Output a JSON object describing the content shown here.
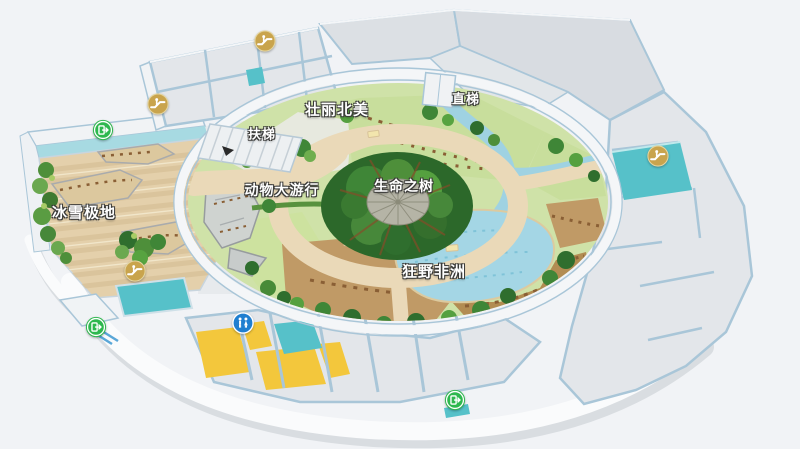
{
  "map": {
    "kind": "indoor-zoo-floor-map",
    "labels": [
      {
        "id": "bingxue-jidi",
        "text": "冰雪极地",
        "x": 84,
        "y": 212,
        "size": 15
      },
      {
        "id": "zhuangli-beimei",
        "text": "壮丽北美",
        "x": 337,
        "y": 109,
        "size": 15
      },
      {
        "id": "kuangye-feizhou",
        "text": "狂野非洲",
        "x": 434,
        "y": 271,
        "size": 15
      },
      {
        "id": "shengming-zhishu",
        "text": "生命之树",
        "x": 404,
        "y": 186,
        "size": 14
      },
      {
        "id": "dongwu-dayouxing",
        "text": "动物大游行",
        "x": 282,
        "y": 190,
        "size": 14
      },
      {
        "id": "futi",
        "text": "扶梯",
        "x": 262,
        "y": 133,
        "size": 13
      },
      {
        "id": "zhiti",
        "text": "直梯",
        "x": 466,
        "y": 98,
        "size": 13
      }
    ],
    "markers": [
      {
        "type": "escalator",
        "x": 265,
        "y": 41
      },
      {
        "type": "escalator",
        "x": 158,
        "y": 104
      },
      {
        "type": "escalator",
        "x": 135,
        "y": 271
      },
      {
        "type": "escalator",
        "x": 658,
        "y": 156
      },
      {
        "type": "exit",
        "x": 103,
        "y": 130
      },
      {
        "type": "exit",
        "x": 96,
        "y": 327
      },
      {
        "type": "exit",
        "x": 455,
        "y": 400
      },
      {
        "type": "restroom",
        "x": 243,
        "y": 323
      }
    ]
  },
  "colors": {
    "bg": "#f1f3f6",
    "wall_edge": "#a9c6d8",
    "floor_gray": "#e3e6ea",
    "floor_white": "#fafbfc",
    "polar_floor": "#e4d0ab",
    "polar_stripe": "#d9c299",
    "water_edge": "#a7dae2",
    "lake": "#a4d6e5",
    "path_tan": "#ead9b8",
    "lawn": "#cfe2a8",
    "lawn_light": "#c8de9c",
    "savanna": "#c09a66",
    "savanna_dark": "#b28c52",
    "rock": "#cfd3d0",
    "pool": "#56c1c9",
    "room_yellow": "#f3c73c",
    "icon_gold": "#c9a44d",
    "icon_green": "#2eb84e",
    "icon_blue": "#1f7fd0",
    "label_fill": "#ffffff",
    "label_outline": "#3a3a38"
  }
}
